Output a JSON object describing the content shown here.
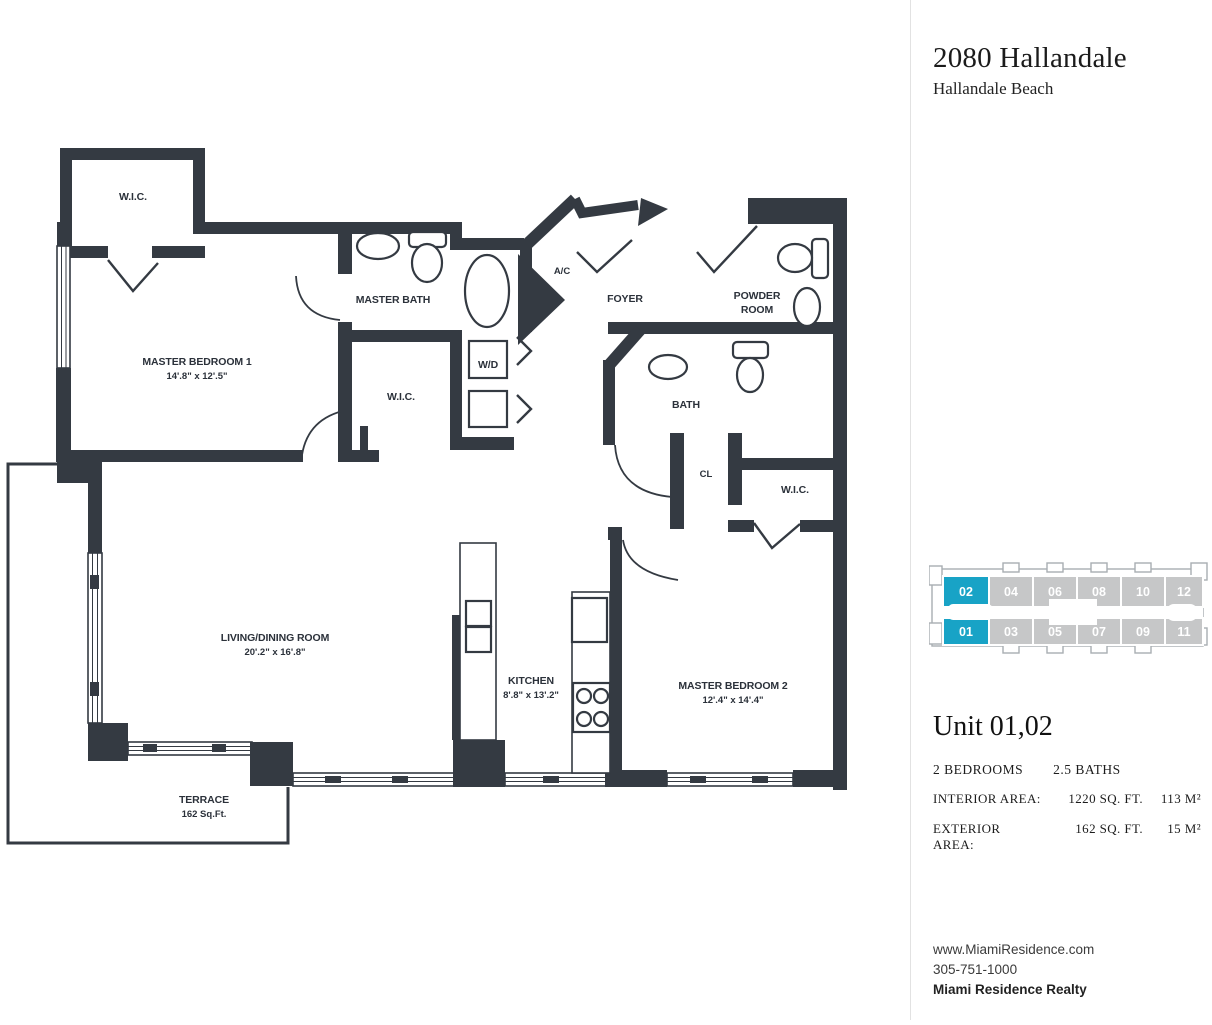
{
  "header": {
    "title": "2080 Hallandale",
    "subtitle": "Hallandale Beach"
  },
  "floorplan": {
    "wall_color": "#343a42",
    "rooms": {
      "wic1": {
        "label": "W.I.C."
      },
      "master_bedroom_1": {
        "label": "MASTER BEDROOM 1",
        "dims": "14'.8\" x 12'.5\""
      },
      "master_bath": {
        "label": "MASTER BATH"
      },
      "wd": {
        "label": "W/D"
      },
      "wic2": {
        "label": "W.I.C."
      },
      "ac": {
        "label": "A/C"
      },
      "foyer": {
        "label": "FOYER"
      },
      "powder_room": {
        "line1": "POWDER",
        "line2": "ROOM"
      },
      "bath": {
        "label": "BATH"
      },
      "cl": {
        "label": "CL"
      },
      "wic3": {
        "label": "W.I.C."
      },
      "living": {
        "label": "LIVING/DINING ROOM",
        "dims": "20'.2\" x 16'.8\""
      },
      "kitchen": {
        "label": "KITCHEN",
        "dims": "8'.8\" x 13'.2\""
      },
      "master_bedroom_2": {
        "label": "MASTER BEDROOM 2",
        "dims": "12'.4\" x 14'.4\""
      },
      "terrace": {
        "label": "TERRACE",
        "area": "162 Sq.Ft."
      }
    }
  },
  "keyplan": {
    "highlight_color": "#18a3c6",
    "cell_color": "#c6c7c8",
    "units": [
      {
        "label": "02",
        "highlighted": true,
        "fill": "#18a3c6"
      },
      {
        "label": "04",
        "highlighted": false,
        "fill": "#c6c7c8"
      },
      {
        "label": "06",
        "highlighted": false,
        "fill": "#c6c7c8"
      },
      {
        "label": "08",
        "highlighted": false,
        "fill": "#c6c7c8"
      },
      {
        "label": "10",
        "highlighted": false,
        "fill": "#c6c7c8"
      },
      {
        "label": "12",
        "highlighted": false,
        "fill": "#c6c7c8"
      },
      {
        "label": "01",
        "highlighted": true,
        "fill": "#18a3c6"
      },
      {
        "label": "03",
        "highlighted": false,
        "fill": "#c6c7c8"
      },
      {
        "label": "05",
        "highlighted": false,
        "fill": "#c6c7c8"
      },
      {
        "label": "07",
        "highlighted": false,
        "fill": "#c6c7c8"
      },
      {
        "label": "09",
        "highlighted": false,
        "fill": "#c6c7c8"
      },
      {
        "label": "11",
        "highlighted": false,
        "fill": "#c6c7c8"
      }
    ]
  },
  "unit_info": {
    "title": "Unit 01,02",
    "bedrooms": "2 BEDROOMS",
    "baths": "2.5 BATHS",
    "interior": {
      "label": "INTERIOR AREA:",
      "sqft": "1220 SQ. FT.",
      "m2": "113 M²"
    },
    "exterior": {
      "label": "EXTERIOR AREA:",
      "sqft": "162 SQ. FT.",
      "m2": "15 M²"
    }
  },
  "footer": {
    "website": "www.MiamiResidence.com",
    "phone": "305-751-1000",
    "company": "Miami Residence Realty"
  }
}
